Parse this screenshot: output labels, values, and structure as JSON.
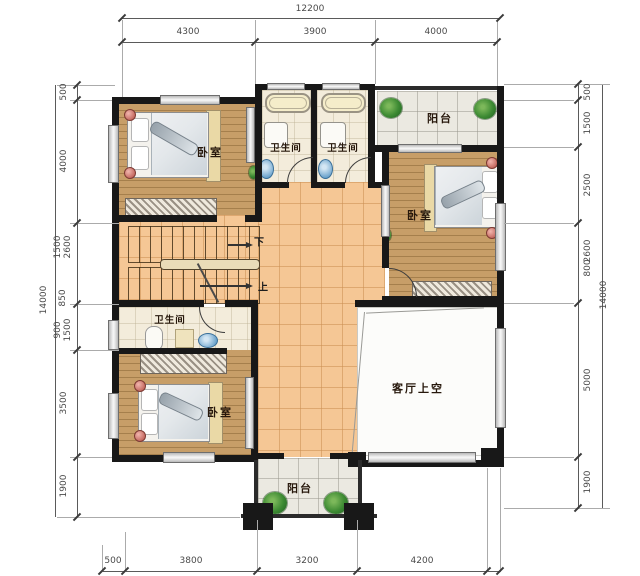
{
  "rooms": {
    "bedroom_tl": "卧室",
    "bath_1": "卫生间",
    "bath_2": "卫生间",
    "balcony_top": "阳台",
    "bedroom_r": "卧室",
    "bath_bl": "卫生间",
    "bedroom_bl": "卧室",
    "living_void": "客厅上空",
    "balcony_bottom": "阳台",
    "stair_down": "下",
    "stair_up": "上"
  },
  "dims": {
    "top_total": "12200",
    "top": [
      "4300",
      "3900",
      "4000"
    ],
    "left_total": "14000",
    "left": [
      "500",
      "4000",
      "1500",
      "2600",
      "850",
      "900",
      "1500",
      "3500",
      "1900"
    ],
    "right": [
      "500",
      "1500",
      "2500",
      "2600",
      "800",
      "5000",
      "1900"
    ],
    "right_total": "14000",
    "bottom": [
      "500",
      "3800",
      "3200",
      "4200"
    ]
  },
  "colors": {
    "wall": "#181818",
    "wood_floor": "#c79e68",
    "warm_tile": "#f5c795",
    "cool_tile": "#ebe9e1",
    "bath_floor": "#f3ecdb",
    "plant_green": "#3d8a33",
    "dim_text": "#4a4a4a"
  }
}
